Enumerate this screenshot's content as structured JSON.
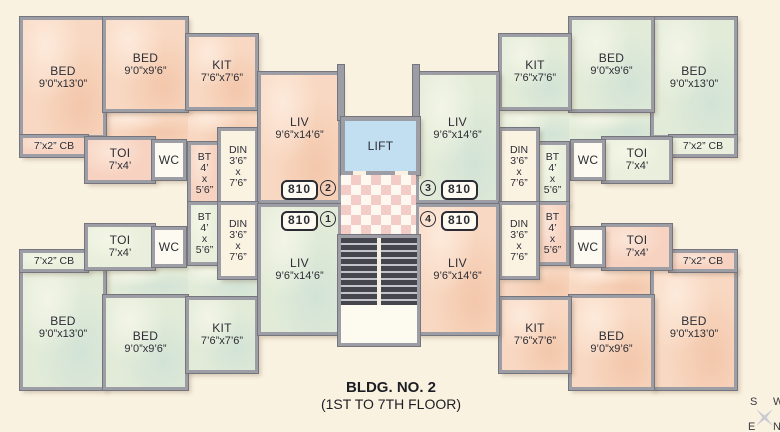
{
  "plan": {
    "title_line1": "BLDG. NO. 2",
    "title_line2": "(1ST TO 7TH FLOOR)",
    "lift_label": "LIFT"
  },
  "rooms": {
    "bed_large": {
      "label": "BED",
      "dims": "9’0”x13’0”"
    },
    "bed_small": {
      "label": "BED",
      "dims": "9’0”x9’6”"
    },
    "kitchen": {
      "label": "KIT",
      "dims": "7’6”x7’6”"
    },
    "living": {
      "label": "LIV",
      "dims": "9’6”x14’6”"
    },
    "toilet": {
      "label": "TOI",
      "dims": "7’x4’"
    },
    "wc": {
      "label": "WC"
    },
    "bath": {
      "label": "BT",
      "d1": "4’",
      "d2": "x",
      "d3": "5’6”"
    },
    "dining": {
      "label": "DIN",
      "d1": "3’6”",
      "d2": "x",
      "d3": "7’6”"
    },
    "cupboard": {
      "label": "7’x2” CB"
    }
  },
  "flats": [
    {
      "circle": "1",
      "number": "810"
    },
    {
      "circle": "2",
      "number": "810"
    },
    {
      "circle": "3",
      "number": "810"
    },
    {
      "circle": "4",
      "number": "810"
    }
  ],
  "compass": {
    "top_left": "S",
    "top_right": "W",
    "bottom_left": "E",
    "bottom_right": "N"
  },
  "colors": {
    "background": "#faf2e1",
    "wall": "#9d9da5",
    "unit_pink": "#f8d8c2",
    "unit_green": "#e2ebd8",
    "lift_blue": "#c2def1",
    "lobby_checker_pink": "#f3cbc7",
    "stair_tread": "#45454d"
  }
}
